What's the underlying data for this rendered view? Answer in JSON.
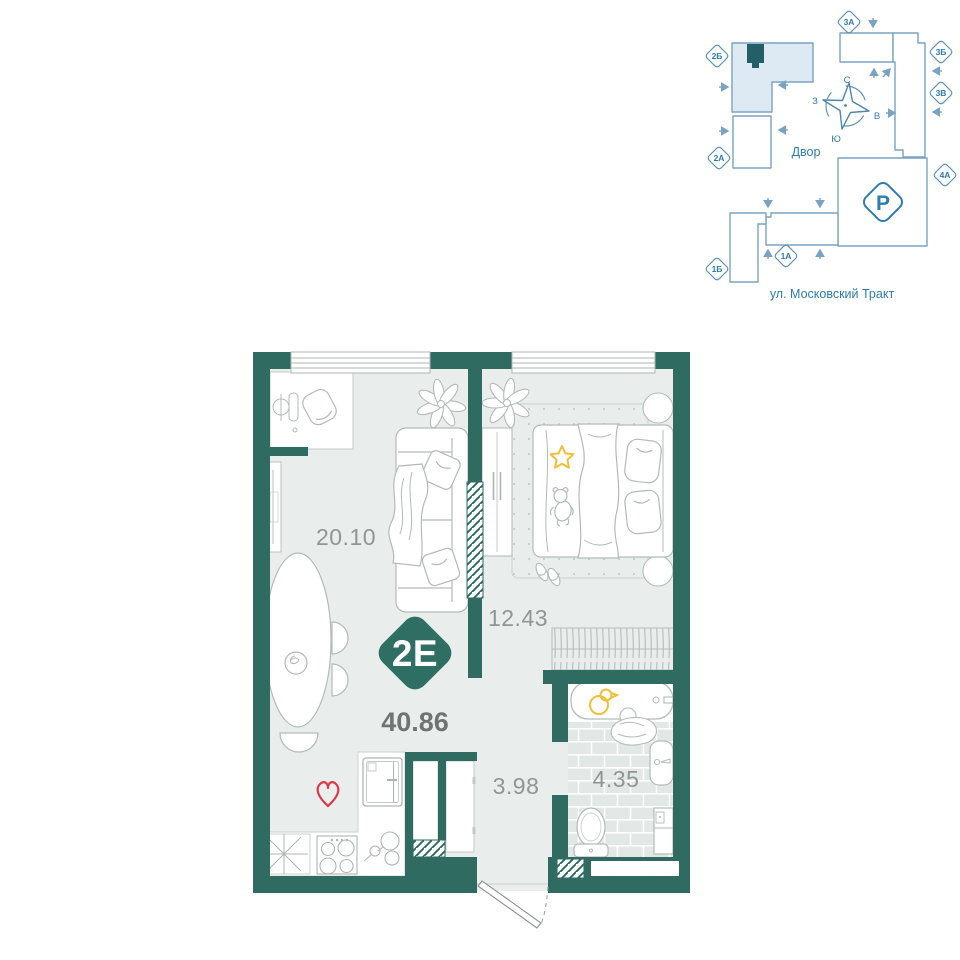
{
  "badge": {
    "type_label": "2E",
    "total_area": "40.86"
  },
  "floor_plan": {
    "rooms": [
      {
        "name": "living-kitchen",
        "area": "20.10"
      },
      {
        "name": "bedroom",
        "area": "12.43"
      },
      {
        "name": "hallway",
        "area": "3.98"
      },
      {
        "name": "bathroom",
        "area": "4.35"
      }
    ]
  },
  "site_plan": {
    "courtyard_label": "Двор",
    "street_label": "ул. Московский Тракт",
    "parking_label": "Р",
    "compass": {
      "north": "С",
      "south": "Ю",
      "west": "З",
      "east": "В"
    },
    "buildings": [
      {
        "id": "2Б",
        "highlighted": true
      },
      {
        "id": "2А",
        "highlighted": false
      },
      {
        "id": "3А",
        "highlighted": false
      },
      {
        "id": "3Б",
        "highlighted": false
      },
      {
        "id": "3В",
        "highlighted": false
      },
      {
        "id": "4А",
        "highlighted": false
      },
      {
        "id": "1А",
        "highlighted": false
      },
      {
        "id": "1Б",
        "highlighted": false
      }
    ]
  },
  "colors": {
    "wall_teal": "#2F6B60",
    "floor": "#E9EEEC",
    "badge_teal": "#2F6F63",
    "accent_yellow": "#EFBF3A",
    "accent_red": "#D93A4A",
    "site_blue_text": "#2E7CB0",
    "site_blue_line": "#7AA3C2",
    "highlight_fill": "#DEEAF3",
    "marker_dark": "#235F66"
  }
}
